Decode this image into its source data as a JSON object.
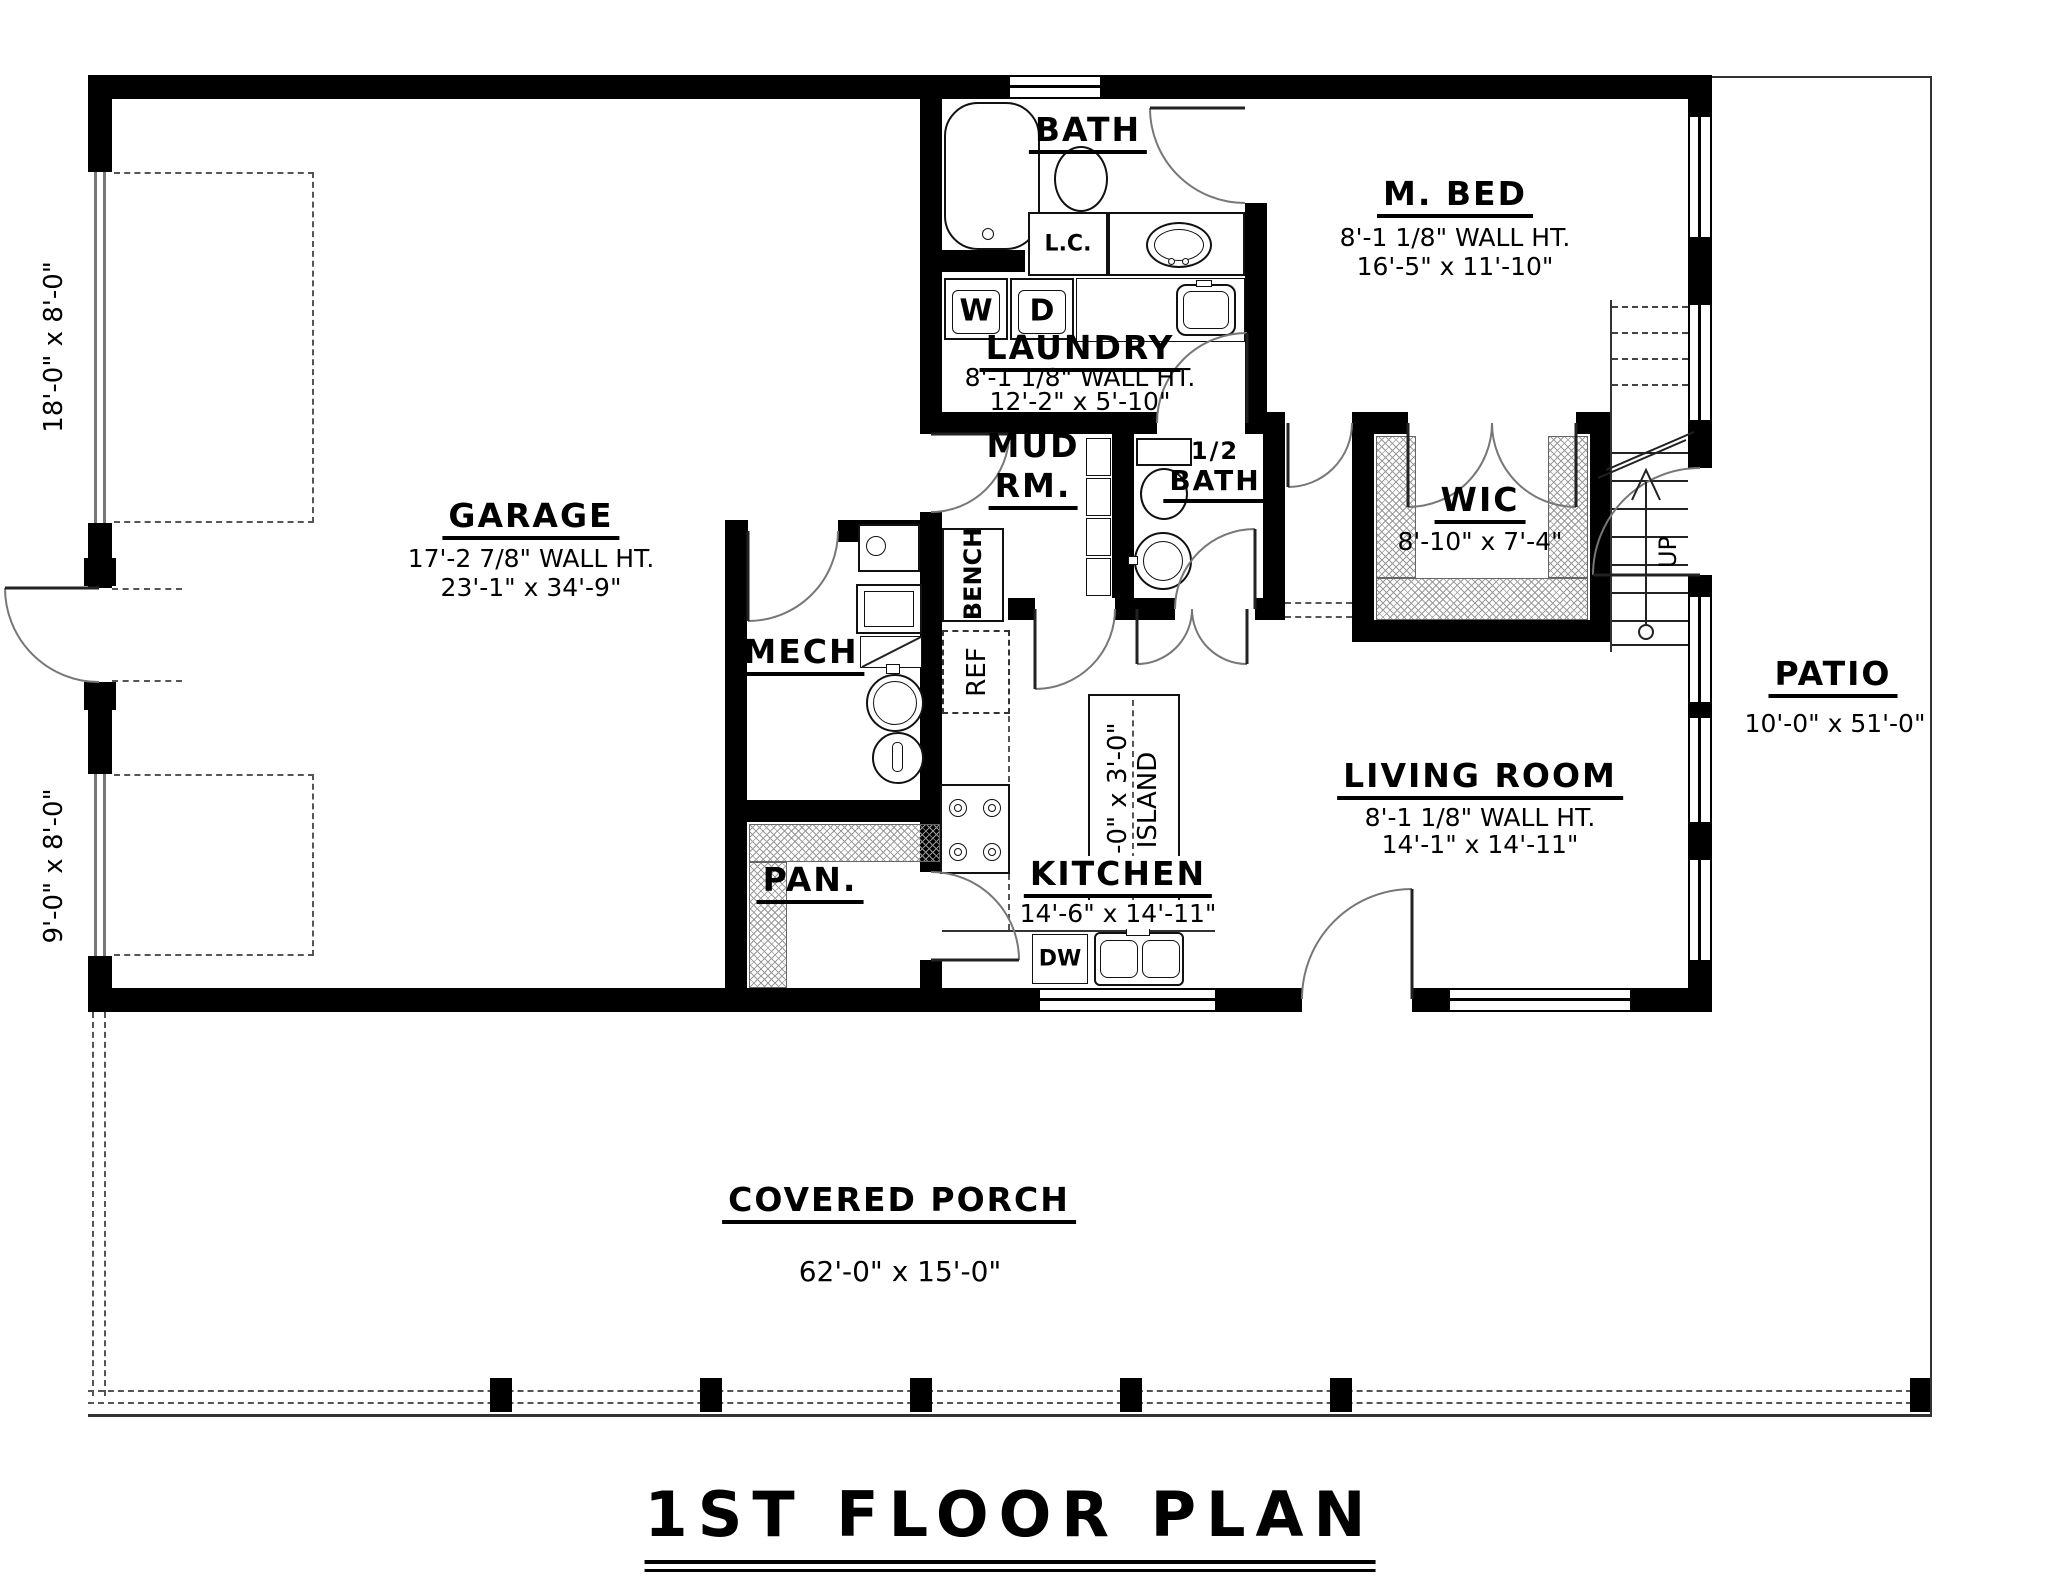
{
  "title": "1ST FLOOR PLAN",
  "rooms": {
    "garage": {
      "name": "GARAGE",
      "wall_ht": "17'-2 7/8\" WALL HT.",
      "dims": "23'-1\" x 34'-9\""
    },
    "bath": {
      "name": "BATH"
    },
    "m_bed": {
      "name": "M. BED",
      "wall_ht": "8'-1 1/8\" WALL HT.",
      "dims": "16'-5\" x 11'-10\""
    },
    "laundry": {
      "name": "LAUNDRY",
      "wall_ht": "8'-1 1/8\" WALL HT.",
      "dims": "12'-2\" x 5'-10\""
    },
    "mud_rm": {
      "line1": "MUD",
      "line2": "RM."
    },
    "half_bath": {
      "line1": "1/2",
      "line2": "BATH"
    },
    "wic": {
      "name": "WIC",
      "dims": "8'-10\" x 7'-4\""
    },
    "mech": {
      "name": "MECH"
    },
    "pan": {
      "name": "PAN."
    },
    "kitchen": {
      "name": "KITCHEN",
      "dims": "14'-6\" x 14'-11\""
    },
    "living_room": {
      "name": "LIVING ROOM",
      "wall_ht": "8'-1 1/8\" WALL HT.",
      "dims": "14'-1\" x 14'-11\""
    },
    "patio": {
      "name": "PATIO",
      "dims": "10'-0\" x 51'-0\""
    },
    "covered_porch": {
      "name": "COVERED PORCH",
      "dims": "62'-0\" x 15'-0\""
    }
  },
  "labels": {
    "washer": "W",
    "dryer": "D",
    "linen_closet": "L.C.",
    "refrigerator": "REF",
    "bench": "BENCH",
    "dishwasher": "DW",
    "up": "UP",
    "island": {
      "line1": "6'-0\" x 3'-0\"",
      "line2": "ISLAND"
    }
  },
  "garage_doors": {
    "large": "18'-0\" x 8'-0\"",
    "small": "9'-0\" x 8'-0\""
  },
  "colors": {
    "wall": "#000000",
    "thin_line": "#333333",
    "swing_line": "#777777",
    "hatch": "#999999",
    "background": "#ffffff"
  }
}
